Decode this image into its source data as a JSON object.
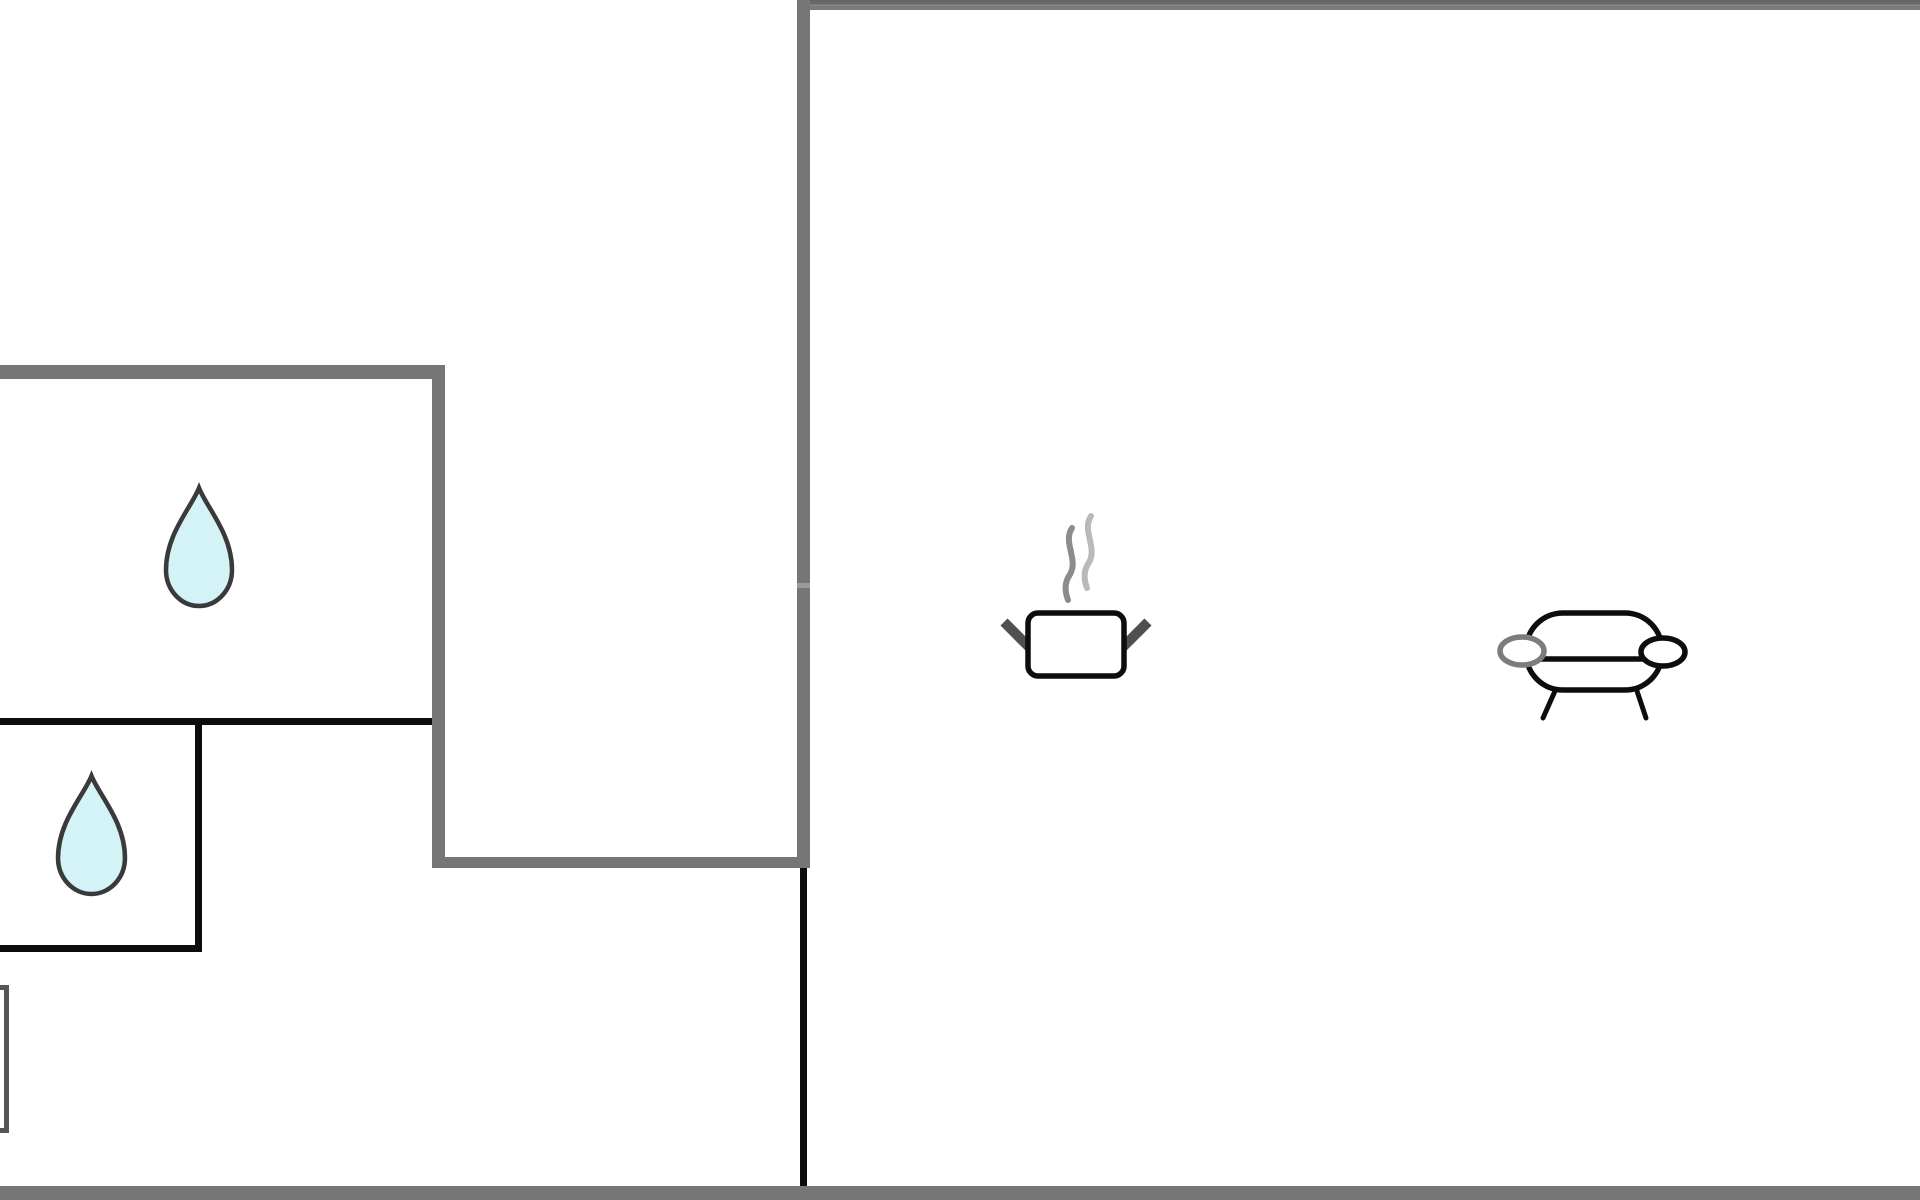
{
  "canvas": {
    "width": 1920,
    "height": 1200,
    "background": "#ffffff"
  },
  "colors": {
    "wall-gray": "#767676",
    "wall-gray-light": "#9b9b9b",
    "wall-black": "#0d0d0d",
    "partial-rect-border": "#565656",
    "drop-fill": "#d3f3f7",
    "drop-stroke": "#3a3a3a",
    "icon-stroke": "#0d0d0d",
    "steam-dark": "#8c8c8c",
    "steam-light": "#b9b9b9",
    "handle-gray": "#4f4f4f",
    "oval-gray": "#7c7c7c"
  },
  "floorplan": {
    "black_walls": [
      {
        "name": "wall-left-room-bottom-divider",
        "x": 0,
        "y": 718,
        "w": 438,
        "h": 7
      },
      {
        "name": "wall-small-room-right",
        "x": 195,
        "y": 718,
        "w": 7,
        "h": 234
      },
      {
        "name": "wall-small-room-bottom",
        "x": 0,
        "y": 945,
        "w": 202,
        "h": 7
      },
      {
        "name": "wall-hall-divider-line",
        "x": 800,
        "y": 863,
        "w": 7,
        "h": 327
      }
    ],
    "gray_walls": [
      {
        "name": "wall-top",
        "x": 797,
        "y": 0,
        "w": 1123,
        "h": 10,
        "variant": "seamed"
      },
      {
        "name": "wall-center-vertical",
        "x": 797,
        "y": 0,
        "w": 13,
        "h": 868
      },
      {
        "name": "wall-left-room-top",
        "x": 0,
        "y": 365,
        "w": 445,
        "h": 14
      },
      {
        "name": "wall-left-room-right",
        "x": 432,
        "y": 365,
        "w": 13,
        "h": 503
      },
      {
        "name": "wall-corridor-bottom",
        "x": 432,
        "y": 857,
        "w": 378,
        "h": 11
      },
      {
        "name": "wall-bottom",
        "x": 0,
        "y": 1186,
        "w": 1920,
        "h": 14
      }
    ],
    "joints": [
      {
        "name": "wall-segment-joint",
        "x": 797,
        "y": 583,
        "w": 13,
        "h": 5
      }
    ],
    "partial_shapes": [
      {
        "name": "partial-rectangle-bottom-left",
        "x": -31,
        "y": 985,
        "w": 40,
        "h": 148
      }
    ],
    "fixtures": [
      {
        "icon": "water-drop-icon",
        "name": "water-drop-icon-large-room",
        "x": 163,
        "y": 485,
        "w": 72,
        "h": 124
      },
      {
        "icon": "water-drop-icon",
        "name": "water-drop-icon-small-room",
        "x": 55,
        "y": 773,
        "w": 73,
        "h": 124
      },
      {
        "icon": "cooking-pot-icon",
        "name": "cooking-pot-icon",
        "x": 995,
        "y": 510,
        "w": 160,
        "h": 175
      },
      {
        "icon": "sofa-icon",
        "name": "sofa-icon",
        "x": 1485,
        "y": 602,
        "w": 210,
        "h": 120
      }
    ]
  }
}
